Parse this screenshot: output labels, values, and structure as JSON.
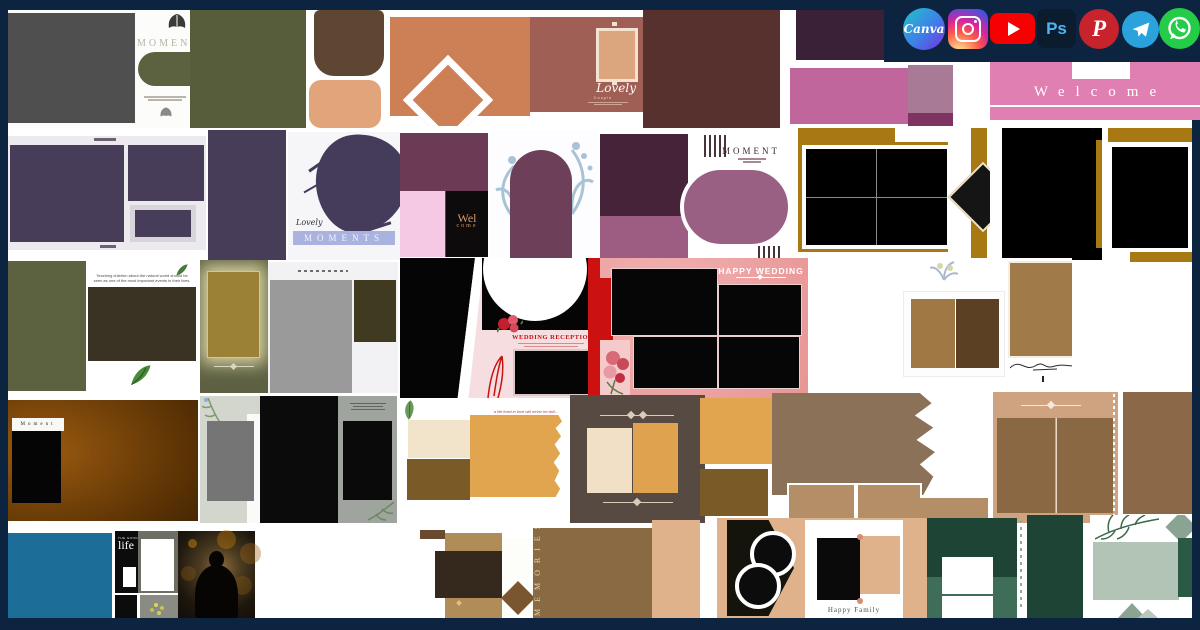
{
  "social_icons": {
    "canva_label": "Canva",
    "photoshop_label": "Ps",
    "pinterest_label": "P",
    "names": [
      "canva",
      "instagram",
      "youtube",
      "photoshop",
      "pinterest",
      "telegram",
      "whatsapp"
    ]
  },
  "templates": {
    "moments": {
      "title": "MOMENTS"
    },
    "lovely_couple": {
      "title": "Lovely",
      "subtitle": "Couple"
    },
    "welcome": {
      "title": "Welcome"
    },
    "lovely_moments": {
      "script": "Lovely",
      "title": "MOMENTS"
    },
    "wel_come": {
      "line1": "Wel",
      "line2": "come"
    },
    "moment_frame": {
      "title": "MOMENT"
    },
    "nature_quote": {
      "caption": "Teaching children about the natural world should be seen as one of the most important events in their lives."
    },
    "wedding_reception": {
      "title": "WEDDING RECEPTION"
    },
    "happy_wedding": {
      "title": "HAPPY WEDDING"
    },
    "moment_dark": {
      "label": "Moment"
    },
    "love_quote": {
      "caption": "a life lived in love will never be dull..."
    },
    "good_life": {
      "eyebrow": "THE GOOD",
      "title": "life"
    },
    "memories": {
      "title": "MEMORIES"
    },
    "happy_family": {
      "caption": "Happy Family"
    }
  },
  "colors": {
    "frame_navy": "#0d2440",
    "welcome_pink": "#e07fb2",
    "gold": "#a87812",
    "wedding_red": "#cc1111",
    "olive": "#575c3a",
    "plum": "#6b3a55",
    "purple_photo": "#473d58",
    "teal_block": "#1d6d99",
    "forest_green": "#1d4435",
    "amber": "#e0a54e",
    "youtube_red": "#f60002",
    "photoshop_blue": "#4fb3f6",
    "pinterest_red": "#c8232c",
    "telegram_blue": "#2aa3dd",
    "whatsapp_green": "#24cc48"
  }
}
